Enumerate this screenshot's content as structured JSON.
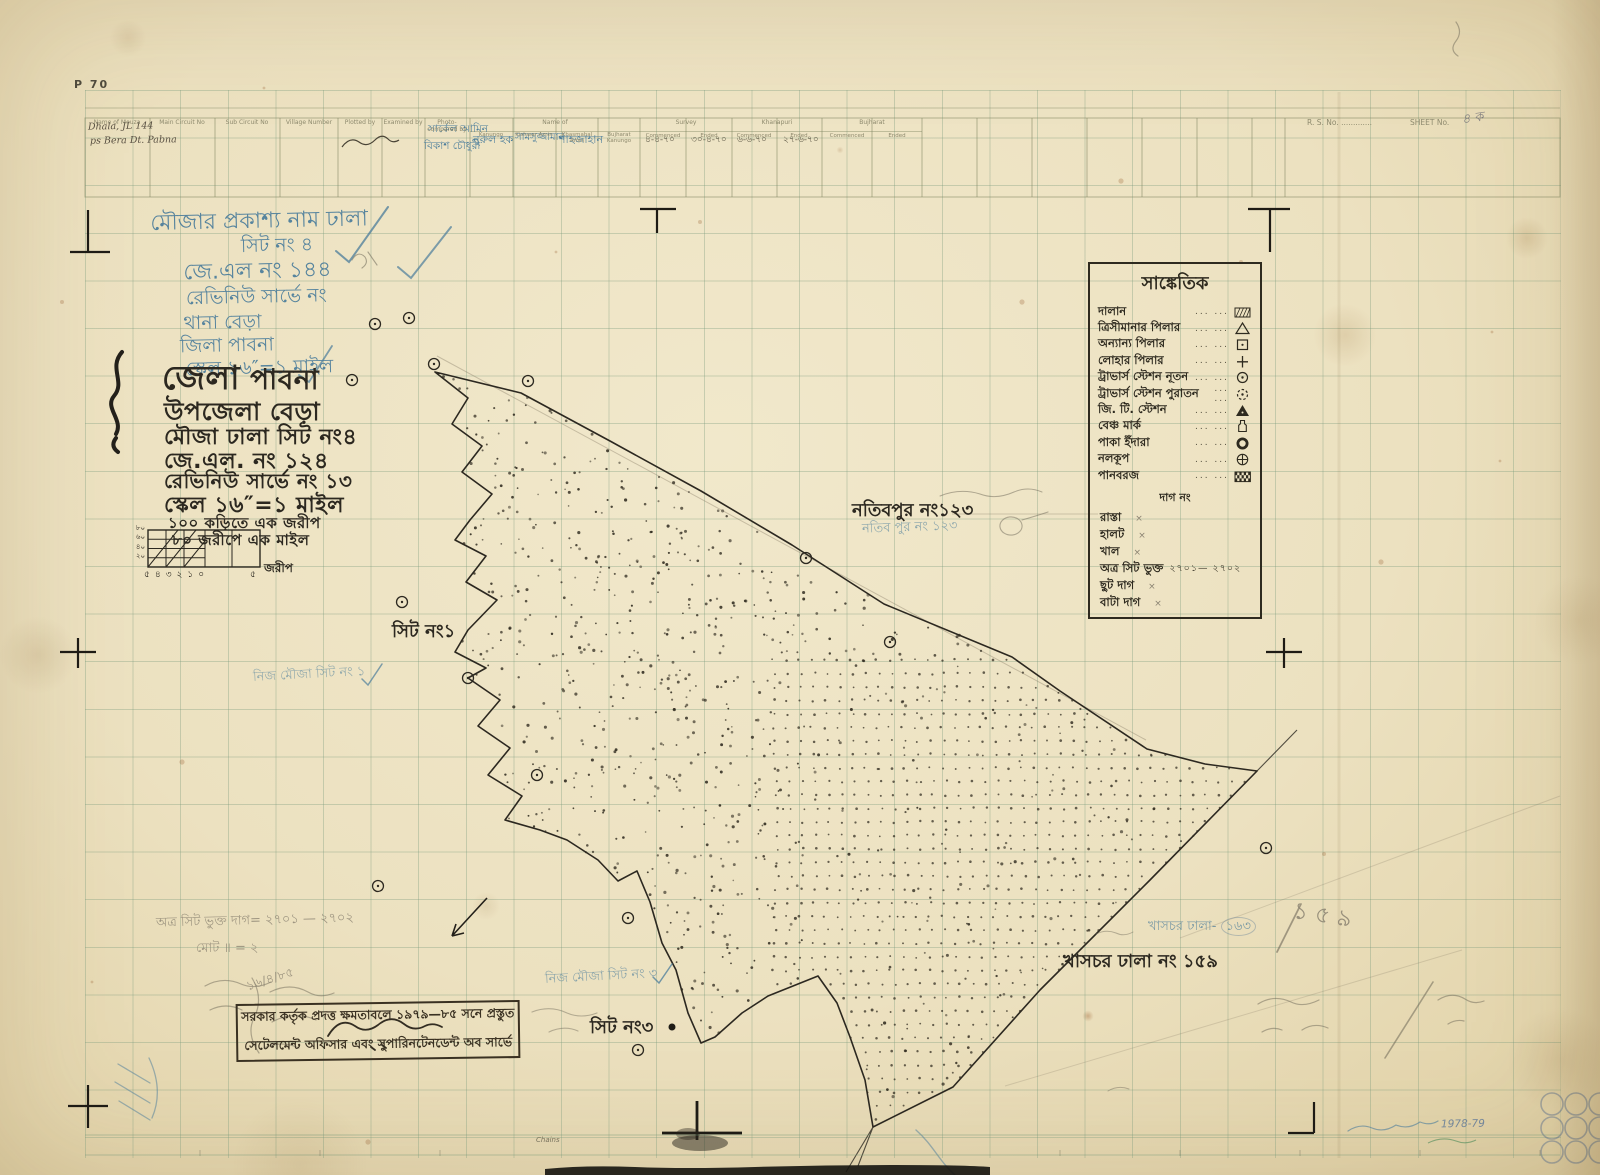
{
  "colors": {
    "paper": "#ece2c3",
    "grid": "#76987a",
    "black_ink": "#2c2820",
    "blue_ink": "#4a7c9b",
    "pencil": "#8b8372",
    "stamp_ink": "#3a3122"
  },
  "page": {
    "plate_no": "P 70",
    "rs_no_label": "R. S. No. .............",
    "sheet_no_label": "SHEET No.",
    "sheet_no_value": "৪ ক",
    "chains_label": "Chains",
    "year_note": "1978-79"
  },
  "header_table": {
    "column_labels": [
      "Name of Mouza",
      "Main Circuit No",
      "Sub Circuit No",
      "Village Number",
      "Plotted by",
      "Examined by",
      "Photo-compared by"
    ],
    "name_of_group": {
      "label": "Name of",
      "sub_labels": [
        "Kanungo",
        "Kishwar Amin",
        "Khasmahal Amin",
        "Bujharat Kanungo"
      ]
    },
    "phase_groups": [
      "Survey",
      "Khanapuri",
      "Bujharat"
    ],
    "phase_sub_labels": [
      "Commenced",
      "Ended"
    ],
    "entries": {
      "mouza_line1": "Dhala, JL 144",
      "mouza_line2": "ps Bera  Dt. Pabna",
      "circle_officer_line1": "সার্কেল আমিন",
      "circle_officer_line2": "বিকাশ চৌধুরী",
      "kanungo": "নুরুল হক",
      "kishwar_amin": "সামসুজ্জামান",
      "khasmahal_amin": "শাহজাহান",
      "survey_commenced": "৪-৪-৭০",
      "survey_ended": "৩০-৪-৭০",
      "khanapuri_commenced": "৬-৬-৭০",
      "khanapuri_ended": "২৭-৬-৭০"
    }
  },
  "blue_title_block": {
    "lines": [
      "মৌজার প্রকাশ্য নাম ঢালা",
      "সিট নং ৪",
      "জে.এল নং ১৪৪",
      "রেভিনিউ সার্ভে নং",
      "থানা বেড়া",
      "জিলা পাবনা",
      "স্কেল ১৬″=১ মাইল"
    ]
  },
  "title_block": {
    "district_label": "জেলা",
    "district_value": "পাবনা",
    "upazila": "উপজেলা বেড়া",
    "mouza": "মৌজা ঢালা  সিট নং৪",
    "jl": "জে.এল. নং ১২৪",
    "revenue_survey": "রেভিনিউ সার্ভে নং ১৩",
    "scale": "স্কেল ১৬″=১ মাইল",
    "conv1": "১০০ কড়িতে এক জরীপ",
    "conv2": "৮০ জরীপে এক মাইল"
  },
  "scale_bar": {
    "left_labels": [
      "৮০",
      "৬০",
      "৪০",
      "২০"
    ],
    "bottom_numbers": [
      "৫",
      "৪",
      "৩",
      "২",
      "১",
      "০"
    ],
    "right_number": "৫",
    "unit": "জরীপ"
  },
  "legend": {
    "title": "সাঙ্কেতিক",
    "items": [
      {
        "label": "দালান",
        "symbol": "hatch-rect"
      },
      {
        "label": "ত্রিসীমানার পিলার",
        "symbol": "triangle"
      },
      {
        "label": "অন্যান্য পিলার",
        "symbol": "square-dot"
      },
      {
        "label": "লোহার পিলার",
        "symbol": "cross"
      },
      {
        "label": "ট্রাভার্স স্টেশন নূতন",
        "symbol": "circle-dot"
      },
      {
        "label": "ট্রাভার্স স্টেশন পুরাতন",
        "symbol": "circle-dot-dashed"
      },
      {
        "label": "জি. টি. স্টেশন",
        "symbol": "triangle-solid"
      },
      {
        "label": "বেঞ্চ মার্ক",
        "symbol": "benchmark"
      },
      {
        "label": "পাকা ইঁদারা",
        "symbol": "ring"
      },
      {
        "label": "নলকূপ",
        "symbol": "circle-plus"
      },
      {
        "label": "পানবরজ",
        "symbol": "checker-rect"
      }
    ],
    "dag_heading": "দাগ নং",
    "line_items": [
      "রাস্তা",
      "হালট",
      "খাল"
    ],
    "inclusion_label": "অত্র সিট ভুক্ত",
    "inclusion_range": "২৭০১— ২৭০২",
    "tail_items": [
      "ছুট দাগ",
      "বাটা দাগ"
    ]
  },
  "map_labels": {
    "village_ne": "নতিবপুর নং১২৩",
    "village_ne_blue": "নতিব পুর নং ১২৩",
    "sheet1": "সিট নং১",
    "sheet1_blue": "নিজ মৌজা সিট নং ১",
    "sheet3": "সিট নং৩",
    "sheet3_blue": "নিজ মৌজা সিট নং ৩",
    "khaschar": "খাসচর ঢালা নং ১৫৯",
    "khaschar_blue_prefix": "খাসচর ঢালা- ",
    "khaschar_blue_number": "১৬৩",
    "khaschar_pencil": "১৫৯"
  },
  "annotations": {
    "pencil_inclusion": "অত্র সিট ভুক্ত দাগ= ২৭০১ — ২৭০২",
    "pencil_total": "মোট ॥ = ২",
    "pencil_date": "১৬/৪/৮৫"
  },
  "stamp": {
    "line1": "সরকার কর্তৃক প্রদত্ত ক্ষমতাবলে ১৯৭৯—৮৫ সনে প্রস্তুত",
    "line2": "সেটেলমেন্ট অফিসার এবং সুপারিনটেনডেন্ট অব সার্ভে"
  }
}
